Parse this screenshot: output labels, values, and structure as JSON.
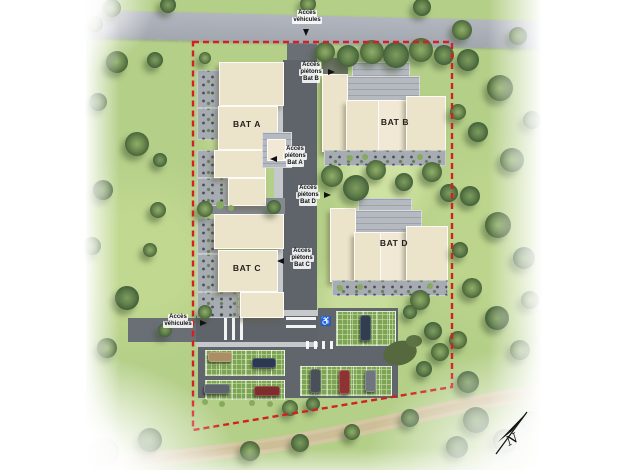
{
  "plan": {
    "type": "residential-site-plan",
    "buildings": [
      {
        "id": "bat-a",
        "label": "BAT A"
      },
      {
        "id": "bat-b",
        "label": "BAT B"
      },
      {
        "id": "bat-c",
        "label": "BAT C"
      },
      {
        "id": "bat-d",
        "label": "BAT D"
      }
    ],
    "annotations": [
      {
        "id": "vehicle-access-north",
        "lines": [
          "Accès",
          "véhicules"
        ],
        "arrow": "down"
      },
      {
        "id": "pedestrian-access-bat-b",
        "lines": [
          "Accès",
          "piétons",
          "Bat B"
        ],
        "arrow": "right"
      },
      {
        "id": "pedestrian-access-bat-a",
        "lines": [
          "Accès",
          "piétons",
          "Bat A"
        ],
        "arrow": "left"
      },
      {
        "id": "pedestrian-access-bat-d",
        "lines": [
          "Accès",
          "piétons",
          "Bat D"
        ],
        "arrow": "right"
      },
      {
        "id": "pedestrian-access-bat-c",
        "lines": [
          "Accès",
          "piétons",
          "Bat C"
        ],
        "arrow": "left"
      },
      {
        "id": "vehicle-access-west",
        "lines": [
          "Accès",
          "véhicules"
        ],
        "arrow": "right"
      }
    ],
    "compass": {
      "label": "N"
    },
    "colors": {
      "boundary": "#d32020",
      "grass": "#b4cf88",
      "public_road": "#a9aeb6",
      "private_road": "#5f646b",
      "building": "#ece3cb",
      "pavers": "#7da357",
      "dirt_path": "#d5c5a3"
    }
  }
}
